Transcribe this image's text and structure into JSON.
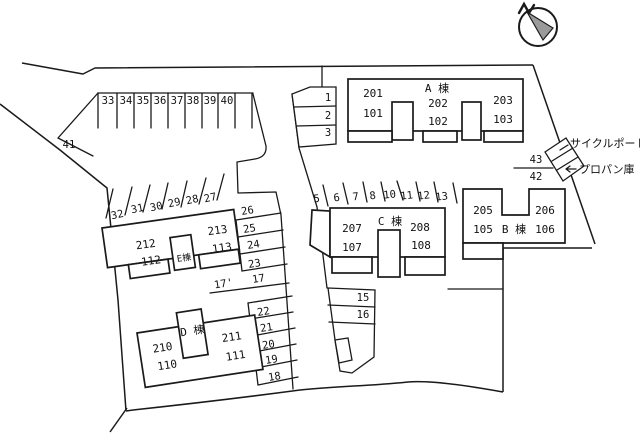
{
  "page": {
    "background": "#ffffff",
    "line_color": "#1a1a1a",
    "compass_fill": "#9a9a9a"
  },
  "compass": {
    "label": "N"
  },
  "facilities": {
    "cycle_port": "サイクルポート",
    "propane_shed": "プロパン庫"
  },
  "buildings": {
    "a": {
      "name": "A 棟",
      "upper": [
        "201",
        "202",
        "203"
      ],
      "lower": [
        "101",
        "102",
        "103"
      ]
    },
    "b": {
      "name": "B 棟",
      "upper": [
        "205",
        "206"
      ],
      "lower": [
        "105",
        "106"
      ]
    },
    "c": {
      "name": "C 棟",
      "upper": [
        "207",
        "208"
      ],
      "lower": [
        "107",
        "108"
      ]
    },
    "d": {
      "name": "D 棟",
      "upper": [
        "210",
        "211"
      ],
      "lower": [
        "110",
        "111"
      ]
    },
    "e": {
      "name": "E棟",
      "upper": [
        "212",
        "213"
      ],
      "lower": [
        "112",
        "113"
      ]
    }
  },
  "parking": {
    "row_top": [
      "33",
      "34",
      "35",
      "36",
      "37",
      "38",
      "39",
      "40"
    ],
    "slope_west": "41",
    "row_small_north": [
      "1",
      "2",
      "3"
    ],
    "row_c_north": [
      "5",
      "6",
      "7",
      "8",
      "10",
      "11",
      "12",
      "13"
    ],
    "row_e_north": [
      "32",
      "31",
      "30",
      "29",
      "28",
      "27"
    ],
    "col_mid_upper": [
      "26",
      "25",
      "24",
      "23",
      "17"
    ],
    "mid_lane": "17'",
    "col_mid_lower": [
      "22",
      "21",
      "20",
      "19",
      "18"
    ],
    "col_c_south": [
      "15",
      "16"
    ],
    "east_top": "43",
    "east_bottom": "42"
  }
}
